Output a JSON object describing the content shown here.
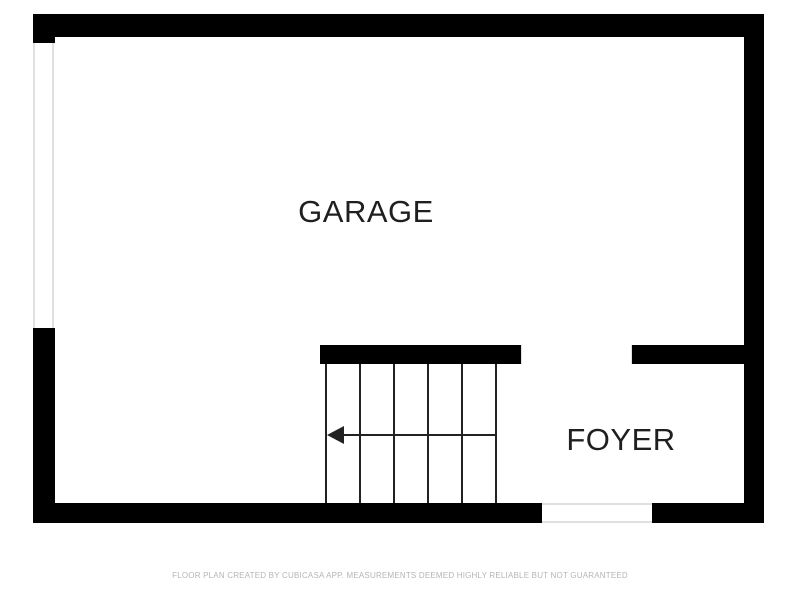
{
  "floor_plan": {
    "rooms": [
      {
        "name": "GARAGE"
      },
      {
        "name": "FOYER"
      }
    ],
    "stairs": {
      "step_lines": 6,
      "arrow_direction": "left"
    },
    "footer_disclaimer": "FLOOR PLAN CREATED BY CUBICASA APP. MEASUREMENTS DEEMED HIGHLY RELIABLE BUT NOT GUARANTEED",
    "colors": {
      "wall": "#000000",
      "background": "#ffffff",
      "room_label": "#1f1f1f",
      "stair_line": "#222222",
      "opening_line": "#e0e0e0",
      "footer_text": "#b5b5b5"
    }
  }
}
